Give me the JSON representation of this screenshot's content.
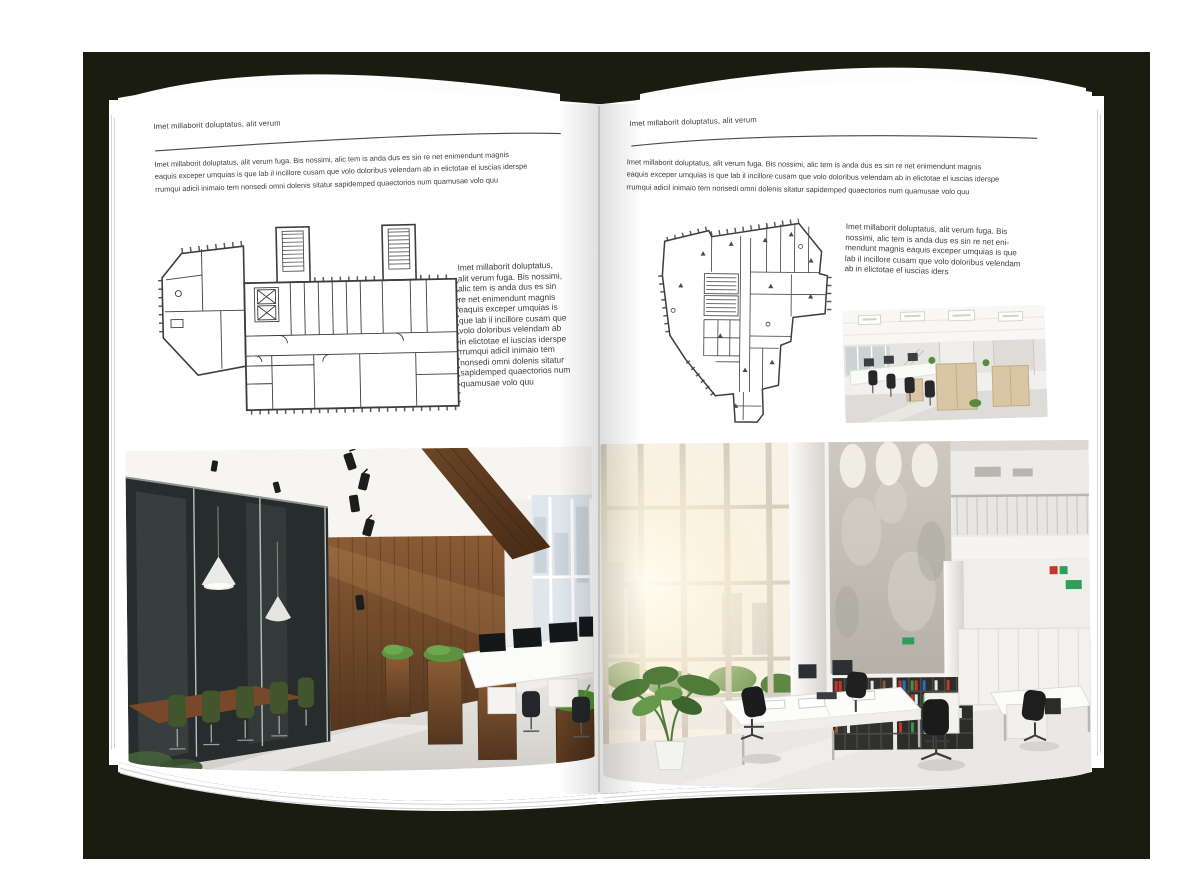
{
  "book": {
    "backdrop_color": "#1b1c10",
    "page_color": "#ffffff"
  },
  "left_page": {
    "header": "Imet millaborit doluptatus, alit verum",
    "intro": "Imet millaborit doluptatus, alit verum fuga. Bis nossimi, alic tem is anda dus es sin re net enimendunt magnis\neaquis exceper umquias is que lab il incillore cusam que volo doloribus velendam ab in elictotae el iuscias iderspe\nrrumqui adicil inimaio tem nonsedi omni dolenis sitatur sapidemped quaectorios num quamusae volo quu",
    "side_column": "Imet millaborit doluptatus,\nalit verum fuga. Bis nossimi,\nalic tem is anda dus es sin\nre net enimendunt magnis\neaquis exceper umquias is\nque lab il incillore cusam que\nvolo doloribus velendam ab\nin elictotae el iuscias iderspe\nrrumqui adicil inimaio tem\nnonsedi omni dolenis sitatur\nsapidemped quaectorios num\nquamusae volo quu"
  },
  "right_page": {
    "header": "Imet millaborit doluptatus, alit verum",
    "intro": "Imet millaborit doluptatus, alit verum fuga. Bis nossimi, alic tem is anda dus es sin re net enimendunt magnis\neaquis exceper umquias is que lab il incillore cusam que volo doloribus velendam ab in elictotae el iuscias iderspe\nrrumqui adicil inimaio tem nonsedi omni dolenis sitatur sapidemped quaectorios num quamusae volo quu",
    "side_paragraph": "Imet millaborit doluptatus, alit verum fuga. Bis\nnossimi, alic tem is anda dus es sin re net eni-\nmendunt magnis eaquis exceper umquias is que\nlab il incillore cusam que volo doloribus velendam\nab in elictotae el iuscias iders"
  }
}
